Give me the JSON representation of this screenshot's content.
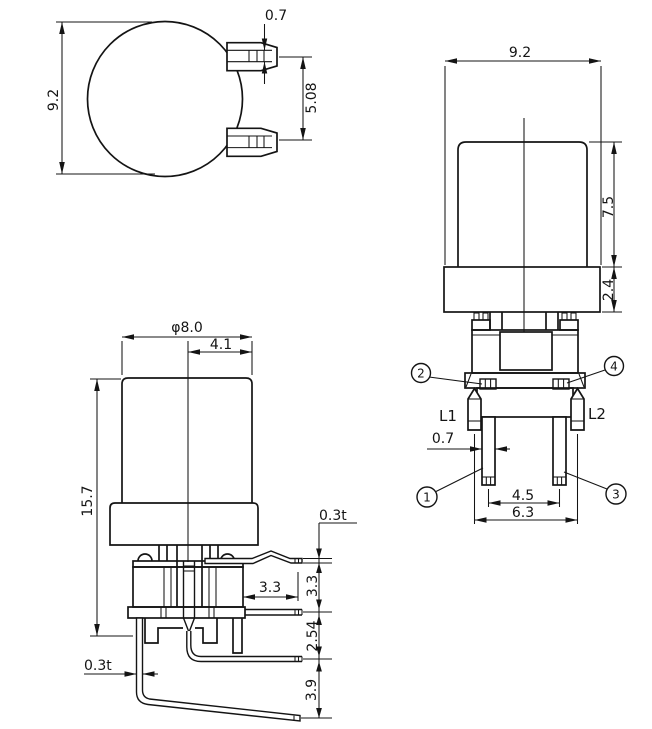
{
  "views": {
    "top": {
      "width": "9.2",
      "terminal_thickness": "0.7",
      "terminal_spacing": "5.08"
    },
    "front": {
      "width": "9.2",
      "cap_height": "7.5",
      "collar_height": "2.4",
      "lamp_lead_left": "L1",
      "lamp_lead_right": "L2",
      "pin_width": "0.7",
      "pin_spacing": "4.5",
      "lamp_lead_spacing": "6.3",
      "callouts": {
        "c1": "1",
        "c2": "2",
        "c3": "3",
        "c4": "4"
      }
    },
    "side": {
      "cap_diameter": "φ8.0",
      "cap_offset": "4.1",
      "total_height": "15.7",
      "lead_thickness_upper": "0.3t",
      "lead_reach": "3.3",
      "lead_gap_1": "3.3",
      "lead_gap_2": "2.54",
      "lead_gap_3": "3.9",
      "lead_thickness_lower": "0.3t"
    }
  },
  "colors": {
    "line": "#141414",
    "background": "#ffffff"
  }
}
